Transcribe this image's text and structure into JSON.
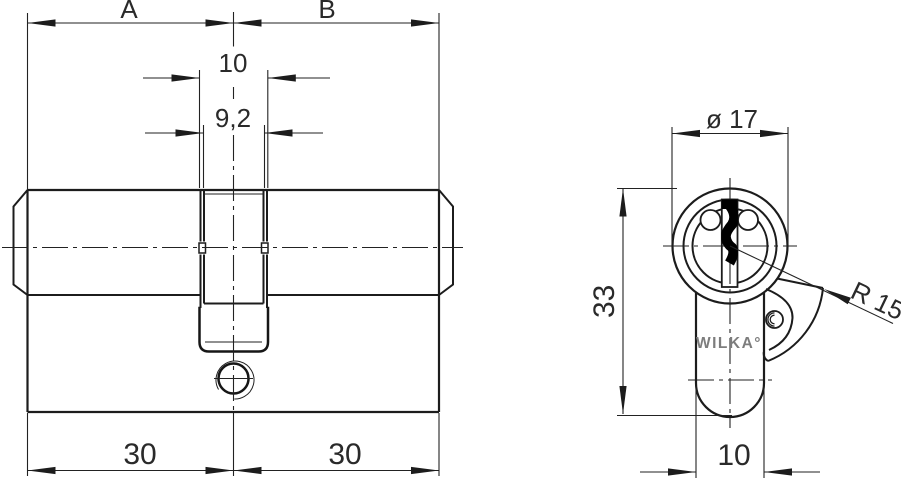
{
  "drawing": {
    "title": "euro-profile-double-cylinder-technical-drawing",
    "colors": {
      "line": "#1c1c1c",
      "background": "#ffffff",
      "key_profile": "#000000",
      "brand_gray": "#7d7d7d"
    },
    "side_view": {
      "dim_a_label": "A",
      "dim_b_label": "B",
      "dim_cam_slot_width": "10",
      "dim_cam_inner_width": "9,2",
      "dim_left_half_length": "30",
      "dim_right_half_length": "30"
    },
    "end_view": {
      "dim_diameter": "ø 17",
      "dim_height": "33",
      "dim_cam_radius": "R 15",
      "dim_body_width": "10",
      "brand": "WILKA°"
    }
  }
}
